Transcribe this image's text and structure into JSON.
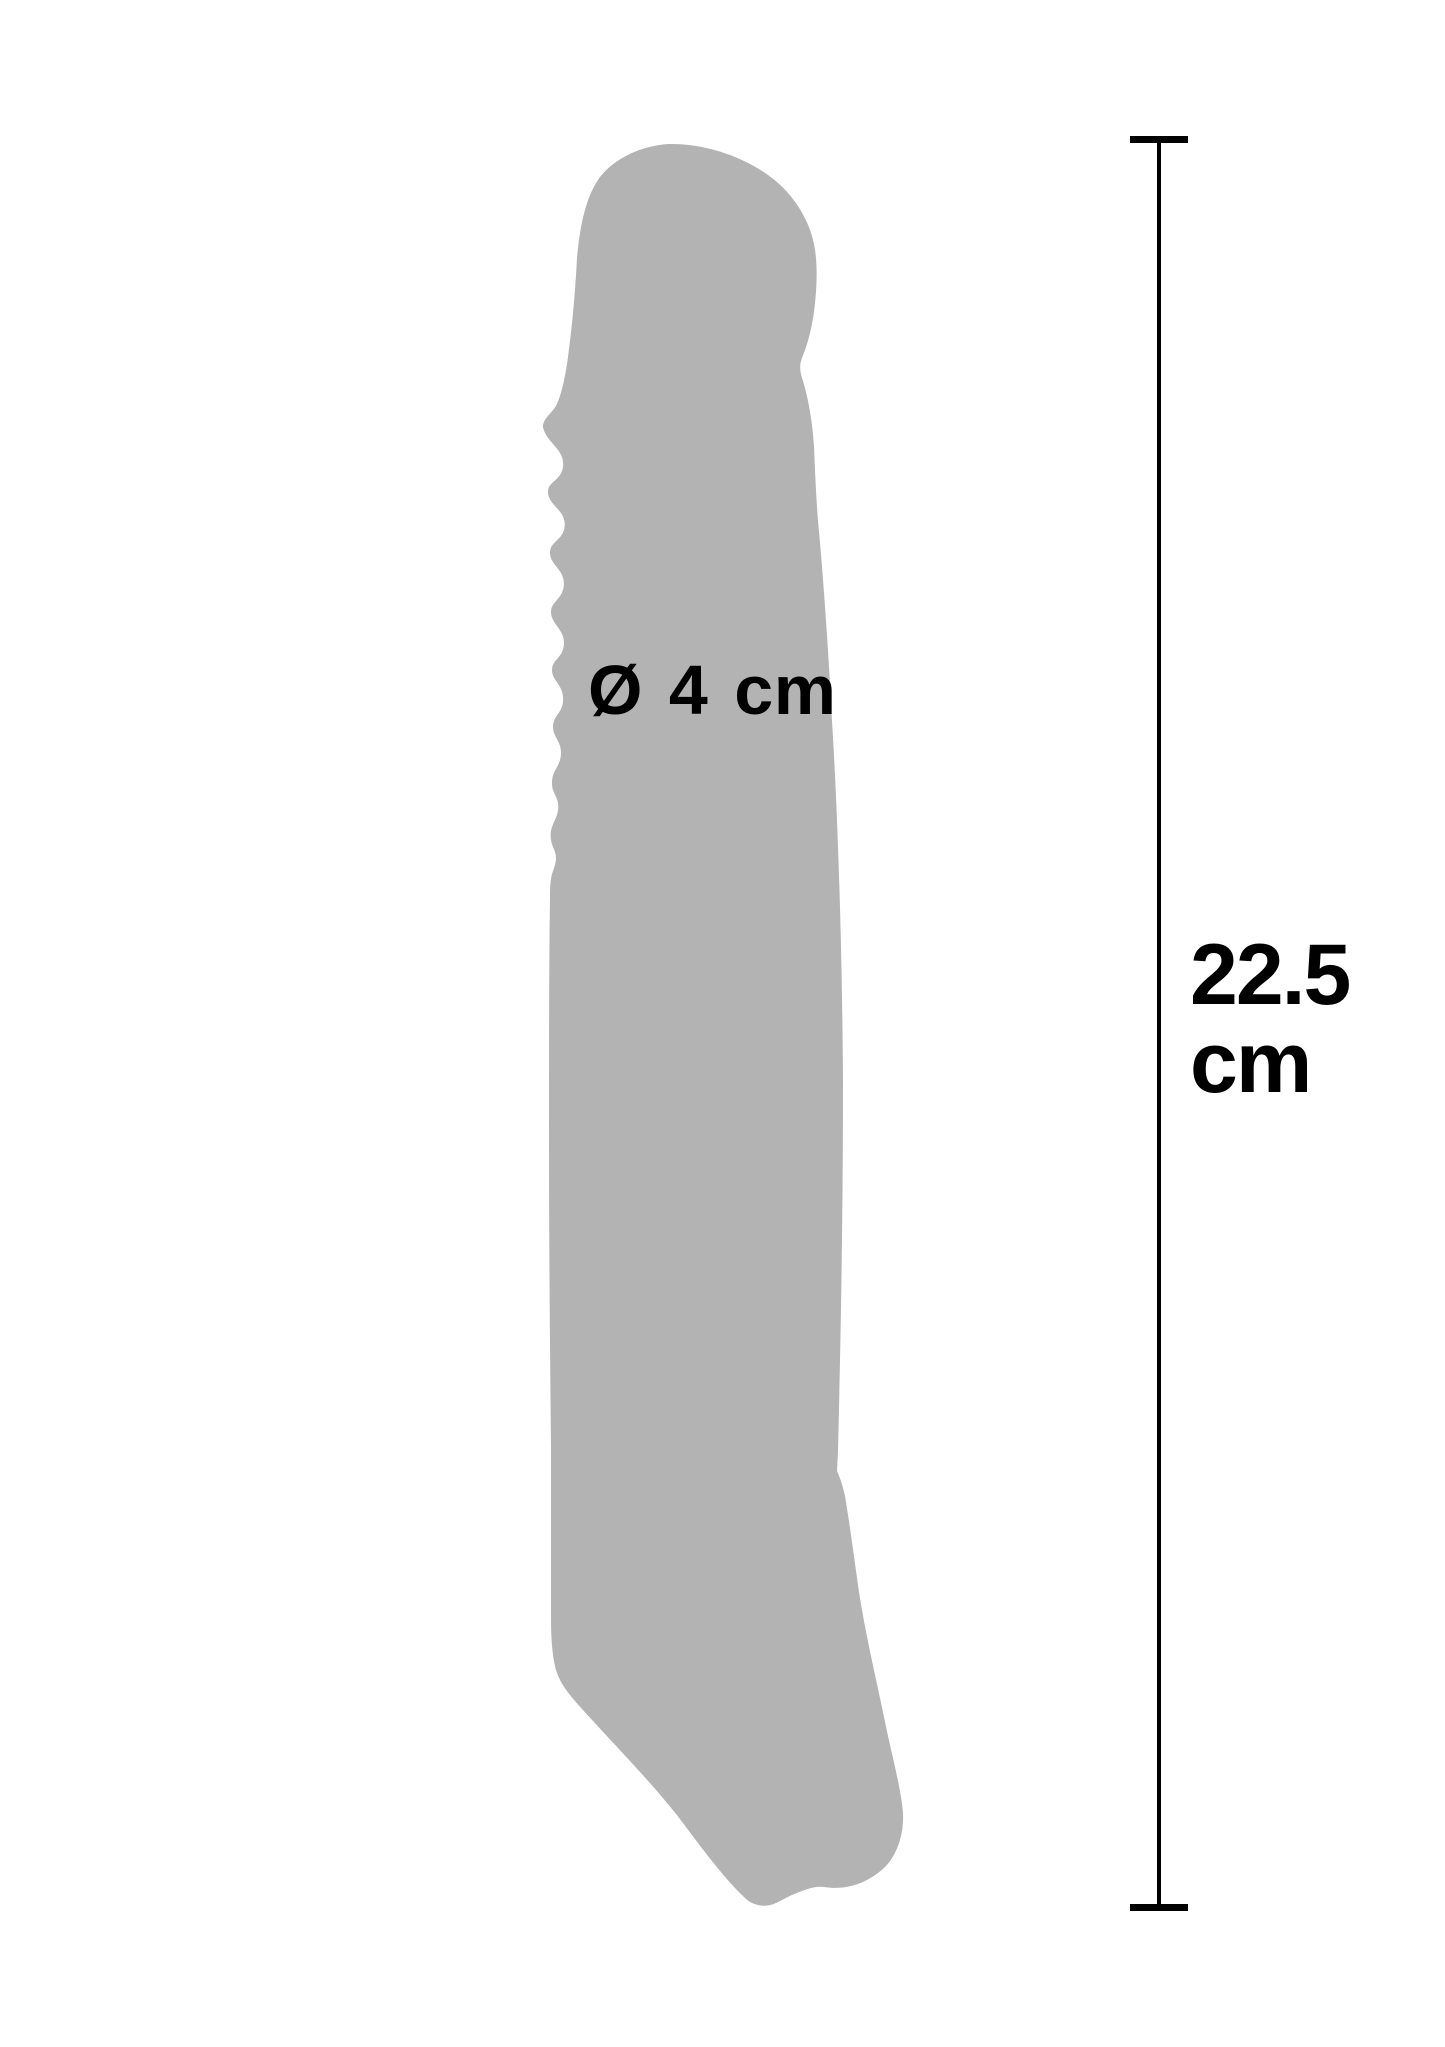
{
  "figure": {
    "type": "product-dimension-diagram",
    "background_color": "#ffffff",
    "silhouette_color": "#b3b3b3",
    "line_color": "#000000",
    "text_color": "#000000",
    "diameter_label": "Ø 4 cm",
    "length": {
      "value": "22.5",
      "unit": "cm"
    }
  }
}
